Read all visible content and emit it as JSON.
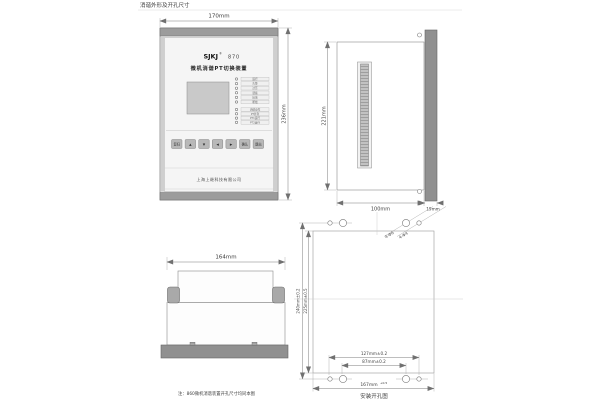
{
  "header": {
    "title": "消谐外形及开孔尺寸"
  },
  "front": {
    "dim_width": "170mm",
    "dim_height": "236mm",
    "brand": "SJKJ",
    "reg": "®",
    "model": "870",
    "name": "微机消谐PT切换装置",
    "company": "上海上继科技有限公司",
    "leds": [
      "运行",
      "告警",
      "过压",
      "谐振",
      "接地",
      "断线",
      "消谐动作",
      "PT并列",
      "PT1运行",
      "PT2运行"
    ],
    "buttons": [
      "复归",
      "▲",
      "▼",
      "◀",
      "▶",
      "确认",
      "退出"
    ]
  },
  "side": {
    "dim_height": "221mm",
    "dim_depth": "100mm",
    "dim_bezel": "19mm"
  },
  "top": {
    "dim_width": "164mm"
  },
  "cutout": {
    "caption": "安装开孔图",
    "label_large": "4-Φ6",
    "label_small": "4-Φ4",
    "dim_v_outer": "240mm±0.2",
    "dim_v_inner": "225mm±0.5",
    "dim_h_outer": "127mm±0.2",
    "dim_h_inner": "87mm±0.2",
    "dim_h_cut": "167mm",
    "dim_h_cut_tol": "+0.5",
    "note": "注：860微机消谐装置开孔尺寸均同本图"
  }
}
